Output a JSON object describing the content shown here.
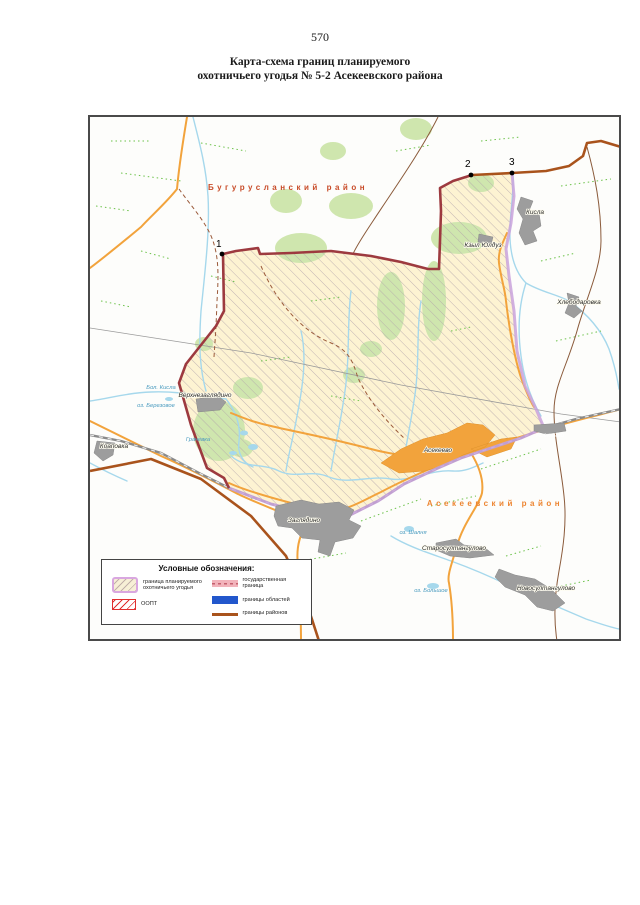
{
  "page": {
    "number": "570",
    "title": [
      "Карта-схема границ планируемого",
      "охотничьего угодья № 5-2 Асекеевского района"
    ]
  },
  "map": {
    "districts": [
      "Бугурусланский район",
      "Асекеевский район"
    ],
    "points": [
      "1",
      "2",
      "3"
    ],
    "settlements": [
      "Верхнезаглядино",
      "Коаповка",
      "Заглядино",
      "Асекеево",
      "Асекеево",
      "Кисла",
      "Кзыл Юлдуз",
      "Хлебодаровка",
      "Старосултангулово",
      "Новосултангулово"
    ],
    "waters": [
      "Бол. Кисла",
      "оз. Березовое",
      "Грачевка",
      "оз. Шалня",
      "оз. Большое"
    ],
    "legend": {
      "title": "Условные обозначения:",
      "items": [
        "граница планируемого охотничьего угодья",
        "ООПТ",
        "государственная граница",
        "границы областей",
        "границы районов"
      ]
    },
    "colors": {
      "hunting_area": "#fdf3d2",
      "oopt_border": "#9d3a3f",
      "hunting_boundary": "#c9a2dc",
      "district_boundary": "#a9531c",
      "state_boundary": "#f2b3bb",
      "oblast_boundary": "#2257cc",
      "road": "#f2a33c",
      "water": "#a6d8ec",
      "forest": "#cfe6ae",
      "settlement": "#9d9d9d",
      "district_label_north": "#c84b28",
      "district_label_south": "#ed8531"
    }
  }
}
